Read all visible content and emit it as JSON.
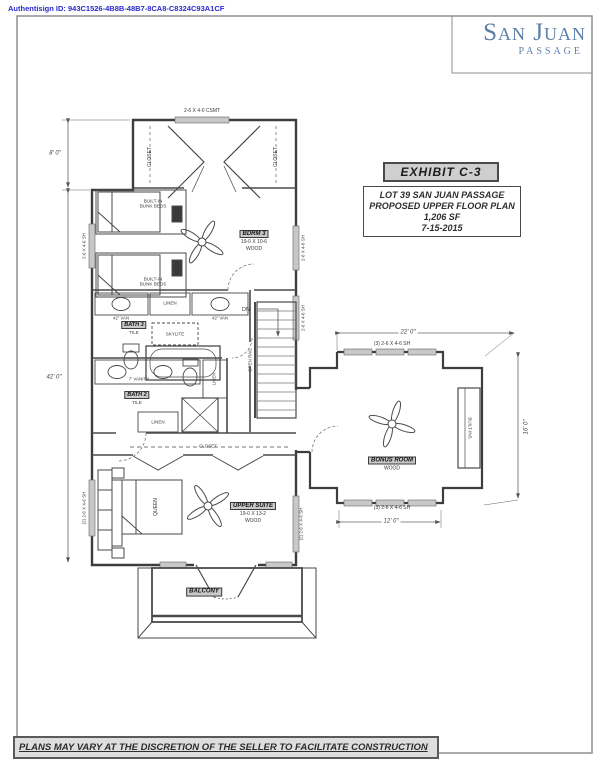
{
  "colors": {
    "logo_blue": "#5c7fa9",
    "authentisign_blue": "#2a2ace",
    "ink": "#3d3d3d",
    "highlight_bg": "#c9c9c9"
  },
  "page": {
    "authentisign_id": "Authentisign ID: 943C1526-4B8B-48B7-8CA8-C8324C93A1CF",
    "footer_note": "PLANS MAY VARY AT THE DISCRETION OF THE SELLER TO FACILITATE CONSTRUCTION"
  },
  "logo": {
    "name": "San Juan",
    "subname": "Passage"
  },
  "exhibit": {
    "title": "EXHIBIT C-3",
    "lines": [
      "LOT 39 SAN JUAN PASSAGE",
      "PROPOSED UPPER FLOOR PLAN",
      "1,206 SF",
      "7-15-2015"
    ]
  },
  "plan": {
    "rooms": {
      "bdrm3": {
        "name": "BDRM 3",
        "size": "19-0 X 10-6",
        "floor": "WOOD"
      },
      "bath3": {
        "name": "BATH 3",
        "floor": "TILE"
      },
      "bath2": {
        "name": "BATH 2",
        "floor": "TILE"
      },
      "upper_suite": {
        "name": "UPPER SUITE",
        "size": "19-0 X 13-2",
        "floor": "WOOD"
      },
      "bonus_room": {
        "name": "BONUS ROOM",
        "floor": "WOOD"
      },
      "balcony": {
        "name": "BALCONY"
      }
    },
    "labels": {
      "closet": "CLOSET",
      "linen": "LINEN",
      "skylite": "SKYLITE",
      "bunk_beds": "BUILT-IN\nBUNK BEDS",
      "van_42": "42\" VAN",
      "vanity_7": "7' VANITY",
      "queen": "QUEEN",
      "built_ins": "BUILT-INS",
      "open_rail": "OPEN RAIL",
      "dn": "DN"
    },
    "windows": {
      "csmt": "2-6 X 4-0 CSMT",
      "sh": "2-6 X 4-6 SH",
      "sh_2": "(2) 2-6 X 4-6 SH",
      "sh_3": "(3) 2-6 X 4-6 SH"
    },
    "dimensions": {
      "upper_height": "8' 0\"",
      "left_height": "42' 0\"",
      "bonus_width": "22' 0\"",
      "bonus_height": "16' 0\"",
      "bonus_lower_width": "12' 0\""
    }
  }
}
